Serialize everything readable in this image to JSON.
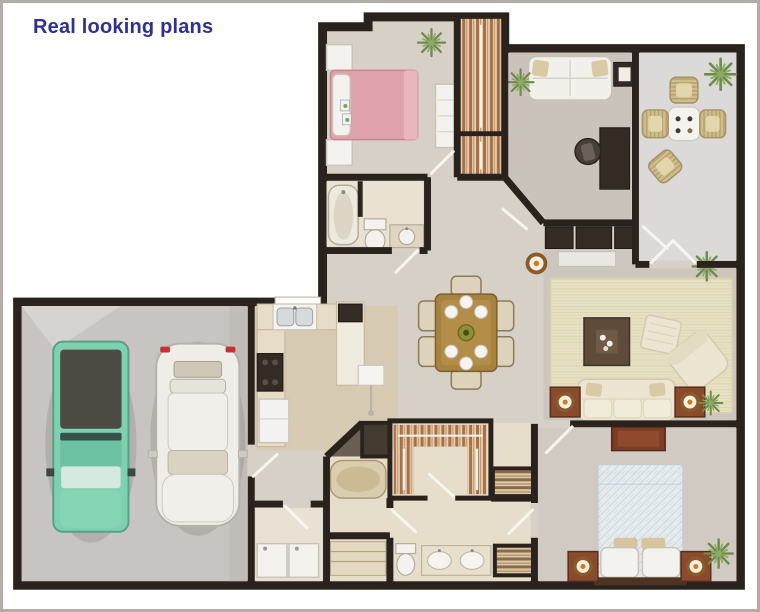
{
  "title": "Real looking plans",
  "image_alt": "3D rendered top-down floor plan of a single-story house with two-car garage",
  "colors": {
    "title_text": "#2e3192",
    "frame_border": "#b3aca7",
    "background": "#ffffff",
    "wall": "#2a231d",
    "carpet": "#d7d0c6",
    "carpet_dark": "#cdc6be",
    "floor_office": "#cac3bb",
    "tile_bath": "#e9e2d2",
    "tile_masterbath": "#e6decb",
    "tile_kitchen": "#d7cab3",
    "floor_laundry": "#e8e1d4",
    "floor_sunroom": "#dbdad8",
    "floor_garage": "#c7c4c1",
    "bed_pink": "#e0a2aa",
    "truck_teal": "#7ed0b0",
    "car_white": "#efede8",
    "wood_table": "#a8823f",
    "sofa_cream": "#ece5d1",
    "furniture_dark": "#332b24",
    "furniture_wood_red": "#8a4a2e",
    "lamp_amber": "#c77f2a",
    "plant_green": "#6c8c4a",
    "plant_light": "#8fa968",
    "closet_rust": "#aa6f46"
  }
}
